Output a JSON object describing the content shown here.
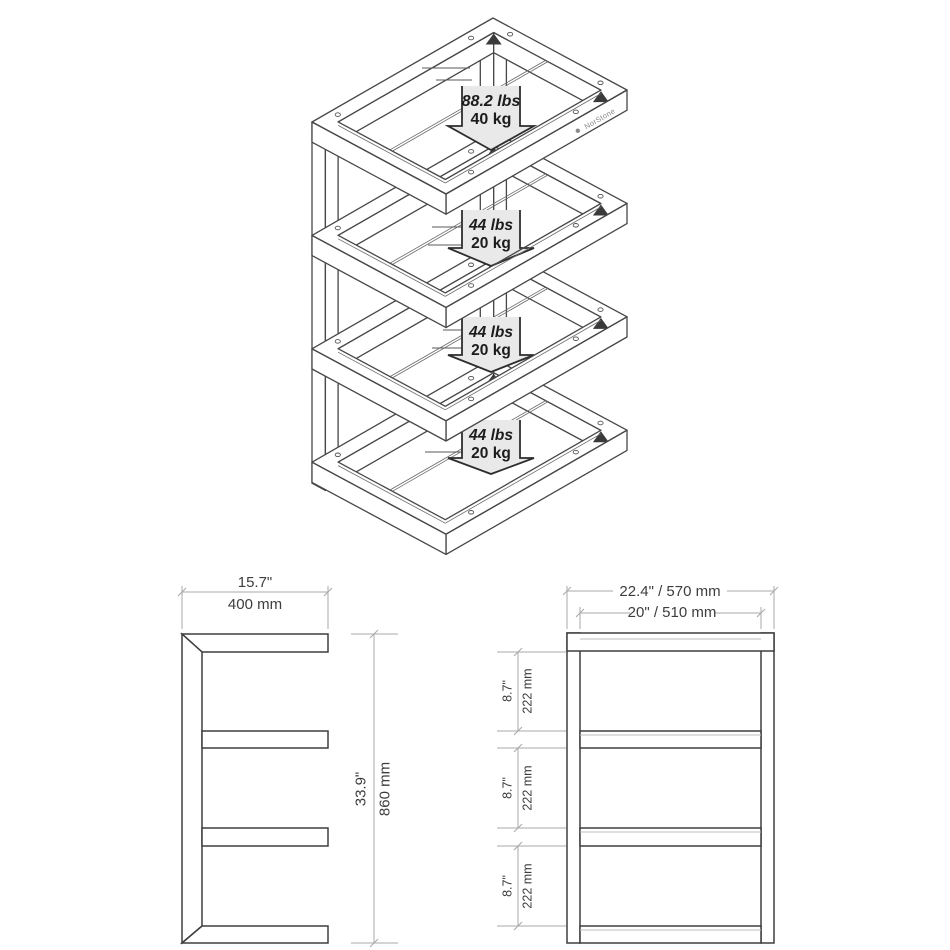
{
  "brand": {
    "logo_text": "NorStone"
  },
  "iso_view": {
    "arrows": [
      {
        "lbs": "88.2 lbs",
        "kg": "40 kg"
      },
      {
        "lbs": "44 lbs",
        "kg": "20 kg"
      },
      {
        "lbs": "44 lbs",
        "kg": "20 kg"
      },
      {
        "lbs": "44 lbs",
        "kg": "20 kg"
      }
    ]
  },
  "side_view": {
    "width_in": "15.7\"",
    "width_mm": "400 mm",
    "height_in": "33.9\"",
    "height_mm": "860 mm"
  },
  "front_view": {
    "outer_width": "22.4\" / 570 mm",
    "inner_width": "20\" / 510 mm",
    "shelf_gaps": [
      {
        "inch": "8.7\"",
        "mm": "222 mm"
      },
      {
        "inch": "8.7\"",
        "mm": "222 mm"
      },
      {
        "inch": "8.7\"",
        "mm": "222 mm"
      }
    ]
  }
}
